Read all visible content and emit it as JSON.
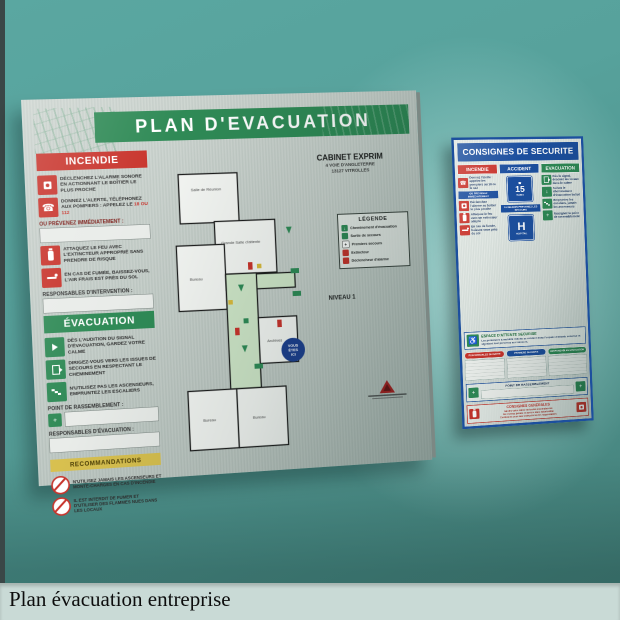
{
  "caption": "Plan évacuation entreprise",
  "colors": {
    "wall_teal": "#4f948e",
    "board_green": "#2f8a56",
    "board_red": "#c8332b",
    "board_blue": "#1c4f9e",
    "band_yellow": "#d8c04f",
    "caption_bg": "#c9dad6"
  },
  "icons": {
    "phone": "☎",
    "wheelchair": "♿",
    "assembly_cross": "+",
    "arrow_down": "↓",
    "legend_arrow": "↓",
    "legend_cross": "+"
  },
  "evacuation_board": {
    "title": "PLAN  D'EVACUATION",
    "company": {
      "name": "CABINET EXPRIM",
      "address_line1": "4 VOIE D'ANGLETERRE",
      "address_line2": "13127 VITROLLES"
    },
    "level_label": "NIVEAU 1",
    "incendie": {
      "header": "INCENDIE",
      "item1": "Déclenchez l'alarme sonore en actionnant le boîtier le plus proche",
      "item2": "Donnez l'alerte, téléphonez aux pompiers : appelez le",
      "item2_numbers": "18 ou 112",
      "prevenez_label": "OU PRÉVENEZ IMMÉDIATEMENT :",
      "item3": "Attaquez le feu avec l'extincteur approprié sans prendre de risque",
      "item4": "En cas de fumée, baissez-vous, l'air frais est près du sol",
      "responsables_label": "RESPONSABLES D'INTERVENTION :"
    },
    "evacuation": {
      "header": "ÉVACUATION",
      "item1": "Dès l'audition du signal d'évacuation, gardez votre calme",
      "item2": "Dirigez-vous vers les issues de secours en respectant le cheminement",
      "item3": "N'utilisez pas les ascenseurs, empruntez les escaliers",
      "rassemblement_label": "POINT DE RASSEMBLEMENT :",
      "responsables_label": "RESPONSABLES D'ÉVACUATION :"
    },
    "recommandations": {
      "header": "RECOMMANDATIONS",
      "item1": "N'utilisez jamais les ascenseurs et monte-charges en cas d'incendie",
      "item2": "Il est interdit de fumer et d'utiliser des flammes nues dans les locaux"
    },
    "legende": {
      "title": "LÉGENDE",
      "items": [
        {
          "icon": "evacuation-route-icon",
          "label": "Cheminement d'évacuation"
        },
        {
          "icon": "emergency-exit-icon",
          "label": "Sortie de secours"
        },
        {
          "icon": "first-aid-icon",
          "label": "Premiers secours"
        },
        {
          "icon": "extinguisher-icon",
          "label": "Extincteur"
        },
        {
          "icon": "alarm-trigger-icon",
          "label": "Déclencheur d'alarme"
        }
      ]
    },
    "plan": {
      "rooms": [
        "Salle de Réunion",
        "Grande Salle d'attente",
        "Bureau",
        "Archives",
        "Bureau",
        "Bureau"
      ],
      "you_are_here": [
        "VOUS",
        "ÊTES",
        "ICI"
      ]
    }
  },
  "consignes_board": {
    "title": "CONSIGNES DE SECURITE",
    "incendie": {
      "header": "INCENDIE",
      "item1": "Donnez l'alerte : appelez les pompiers au 18 ou le 112",
      "band": "OU PREVENEZ IMMEDIATEMENT",
      "item2": "Déclenchez l'alarme au boîtier le plus proche",
      "item3": "Attaquez le feu avec un extincteur adapté",
      "item4": "En cas de fumée, baissez-vous près du sol"
    },
    "accident": {
      "header": "ACCIDENT",
      "phone_sign": "15",
      "phone_caption": "SAMU",
      "band": "AU BESOIN PREVENEZ LES SECOURS",
      "hospital_sign": "H",
      "hospital_caption": "HOPITAL"
    },
    "evacuation": {
      "header": "EVACUATION",
      "item1": "Dès le signal, évacuez les locaux dans le calme",
      "item2": "Suivez le cheminement d'évacuation balisé",
      "item3": "Empruntez les escaliers, jamais les ascenseurs",
      "item4": "Rejoignez le point de rassemblement"
    },
    "espace_attente": {
      "title": "ESPACE D'ATTENTE SECURISE",
      "text": "Les personnes à mobilité réduite se rendent dans l'espace d'attente sécurisé et signalent leur présence aux secours."
    },
    "pills": [
      "RESPONSABLES SECURITE",
      "PREMIERS SECOURS",
      "RESPONSABLES EVACUATION"
    ],
    "rassemblement_label": "POINT DE RASSEMBLEMENT",
    "generales": {
      "title": "CONSIGNES GENERALES",
      "line1": "Gardez votre calme en toutes circonstances",
      "line2": "Ne revenez jamais en arrière sans autorisation",
      "line3": "Conformez-vous aux instructions des responsables"
    }
  }
}
